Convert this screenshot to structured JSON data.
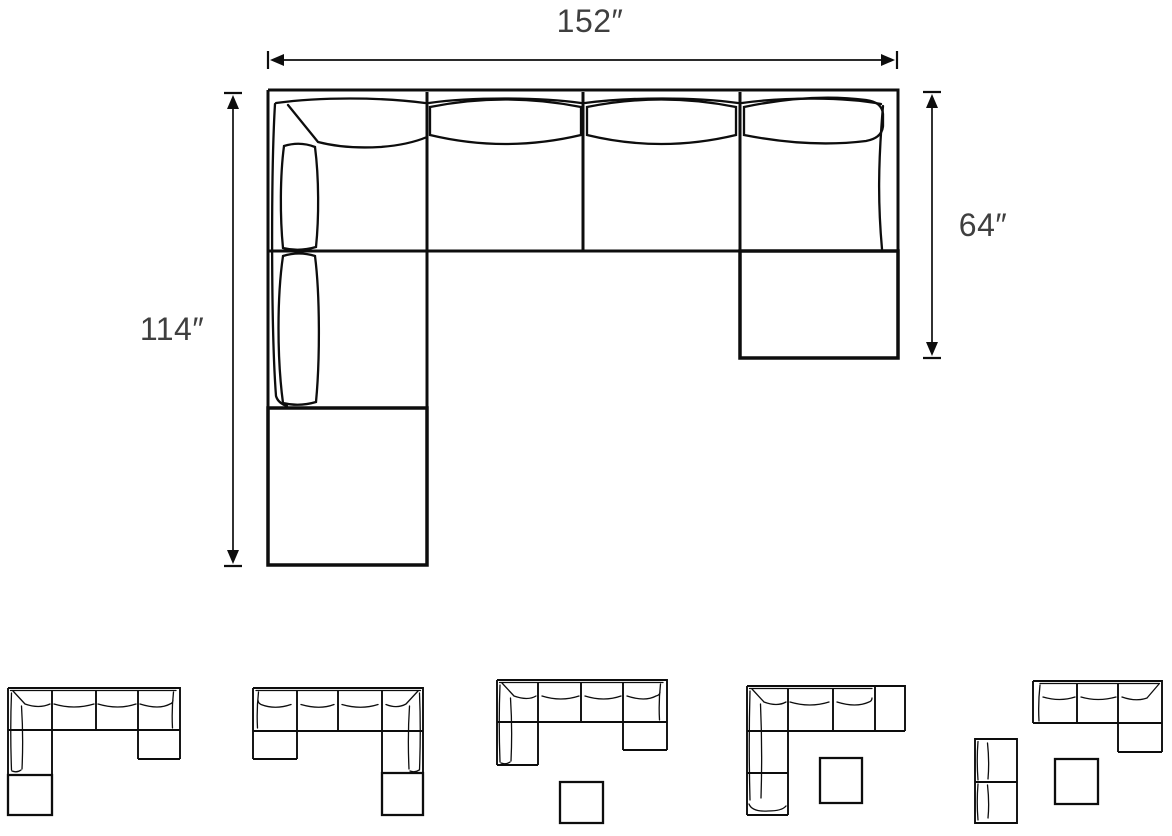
{
  "colors": {
    "background": "#ffffff",
    "line": "#0d0d0d",
    "dimension_text": "#3f3f3f"
  },
  "diagram": {
    "name": "sectional-sofa-top-view-dimension-diagram",
    "dimensions": {
      "width_label": "152″",
      "left_height_label": "114″",
      "right_height_label": "64″"
    }
  },
  "thumbnails": [
    {
      "name": "u-sectional-left-chaise-with-ottoman"
    },
    {
      "name": "u-sectional-right-chaise-with-ottoman"
    },
    {
      "name": "u-sectional-with-detached-ottoman"
    },
    {
      "name": "l-sectional-left-chaise-with-detached-ottoman"
    },
    {
      "name": "corner-sofa-with-armless-piece-and-ottoman"
    }
  ]
}
